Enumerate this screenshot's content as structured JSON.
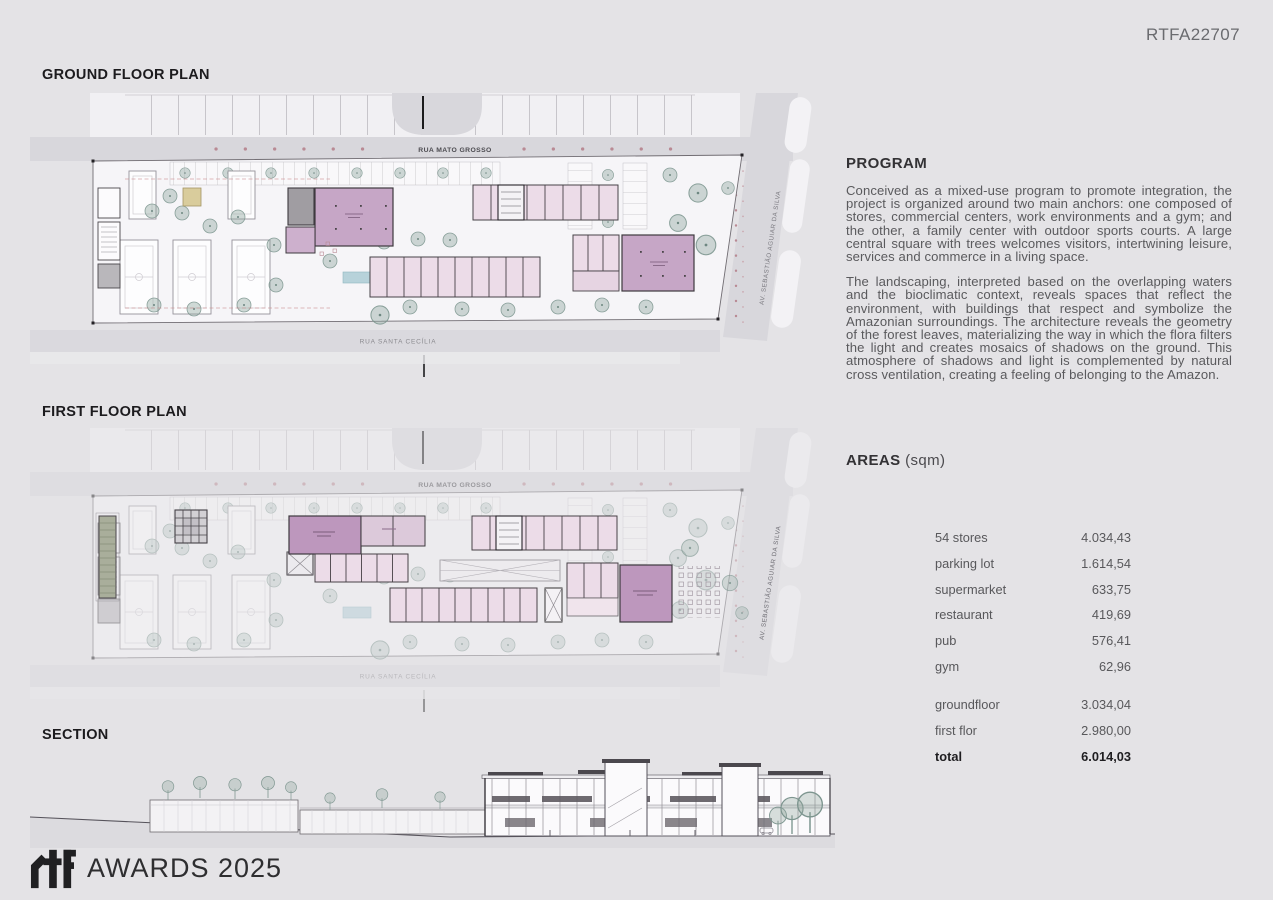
{
  "page": {
    "code": "RTFA22707"
  },
  "plans": {
    "ground": {
      "title": "GROUND FLOOR PLAN"
    },
    "first": {
      "title": "FIRST FLOOR PLAN"
    },
    "section": {
      "title": "SECTION"
    }
  },
  "streets": {
    "top": "RUA MATO GROSSO",
    "bottom": "RUA SANTA CECÍLIA",
    "side": "AV. SEBASTIÃO AGUIAR DA SILVA"
  },
  "program": {
    "title": "PROGRAM",
    "paragraphs": [
      "Conceived as a mixed-use program to promote integration, the project is organized around two main anchors: one composed of stores, commercial centers, work environments and a gym; and the other, a family center with outdoor sports courts. A large central square with trees welcomes visitors, intertwining leisure, services and commerce in a living space.",
      "The landscaping, interpreted based on the overlapping waters and the bioclimatic context, reveals spaces that reflect the environment, with buildings that respect and symbolize the Amazonian surroundings. The architecture reveals the geometry of the forest leaves, materializing the way in which the flora filters the light and creates mosaics of shadows on the ground. This atmosphere of shadows and light is complemented by natural cross ventilation, creating a feeling of belonging to the Amazon."
    ]
  },
  "areas": {
    "title": "AREAS",
    "unit": "(sqm)",
    "rows": [
      {
        "label": "54 stores",
        "value": "4.034,43"
      },
      {
        "label": "parking lot",
        "value": "1.614,54"
      },
      {
        "label": "supermarket",
        "value": "633,75"
      },
      {
        "label": "restaurant",
        "value": "419,69"
      },
      {
        "label": "pub",
        "value": "576,41"
      },
      {
        "label": "gym",
        "value": "62,96"
      }
    ],
    "summary": [
      {
        "label": "groundfloor",
        "value": "3.034,04"
      },
      {
        "label": "first flor",
        "value": "2.980,00"
      }
    ],
    "total": {
      "label": "total",
      "value": "6.014,03"
    }
  },
  "footer": {
    "logo_text": "rtf",
    "brand": "AWARDS 2025"
  },
  "colors": {
    "background": "#e4e3e6",
    "road": "#d8d7dc",
    "site": "#f6f5f8",
    "purple": "#c6a6c6",
    "purple_first": "#bd97bd",
    "pink_store": "#ecdce8",
    "tan": "#d9cc9c",
    "pool": "#b7d2da",
    "tree": "#8ea69f",
    "street_dot": "#b98a94",
    "green_strip": "#a9ae9b"
  }
}
